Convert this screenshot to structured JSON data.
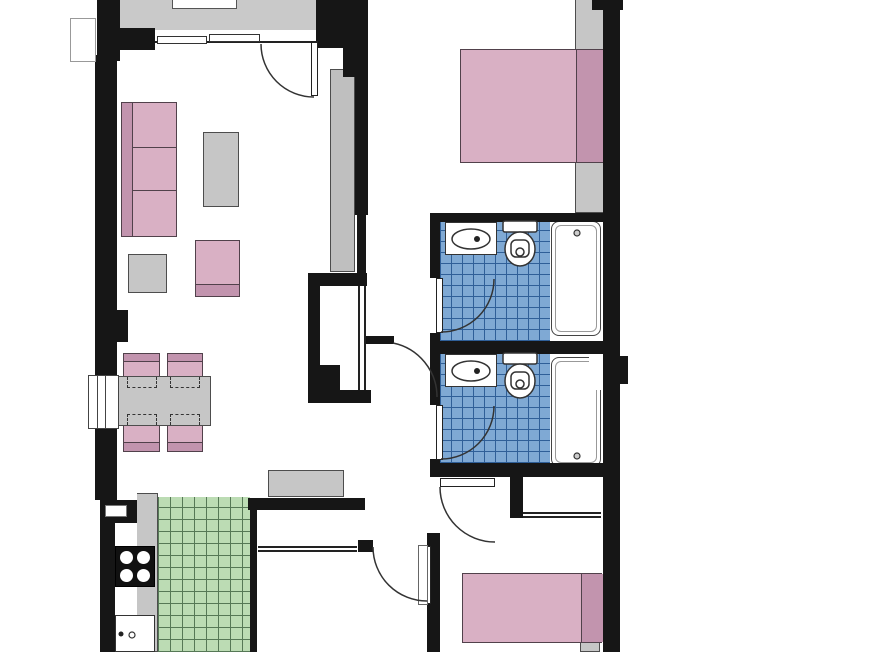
{
  "title": "Apartment floor plan",
  "colors": {
    "wall": "#161616",
    "room": "#ffffff",
    "terrace": "#c9c9c9",
    "gray": "#c6c6c6",
    "gray-border": "#4d4d4d",
    "pink": "#d9b0c4",
    "pink-dark": "#c294ae",
    "pink-border": "#51414b",
    "blue-tile": "#7fa9d4",
    "blue-line": "#2f5f98",
    "green-tile": "#bcdcb4",
    "green-line": "#567856"
  },
  "rooms": {
    "terrace": {
      "name": "Terrace"
    },
    "living": {
      "name": "Living room"
    },
    "dining": {
      "name": "Dining area"
    },
    "kitchen": {
      "name": "Kitchen"
    },
    "hallway": {
      "name": "Hallway"
    },
    "bath1": {
      "name": "Bathroom 1"
    },
    "bath2": {
      "name": "Bathroom 2"
    },
    "bedroom1": {
      "name": "Bedroom 1"
    },
    "bedroom2": {
      "name": "Bedroom 2"
    },
    "storage": {
      "name": "Storage room"
    }
  },
  "furniture": {
    "sofa": "Sofa",
    "coffee_table": "Coffee table",
    "side_table": "Side table",
    "armchair": "Armchair",
    "wardrobe": "Wardrobe",
    "dining_table": "Dining table",
    "dining_chair": "Dining chair",
    "sideboard": "Sideboard",
    "counter": "Kitchen counter",
    "stove": "Stove",
    "kitchen_sink": "Kitchen sink",
    "double_bed": "Double bed",
    "single_bed": "Single bed",
    "bathtub": "Bathtub",
    "toilet": "Toilet",
    "washbasin": "Washbasin",
    "closet": "Built-in closet",
    "nightstand": "Nightstand",
    "planter": "Planter"
  },
  "openings": {
    "entry_sliding_door": "Entry sliding door",
    "entry_door": "Entry door",
    "window": "Window",
    "door": "Door",
    "sliding_door": "Sliding closet door",
    "door_swing": "Door swing"
  }
}
